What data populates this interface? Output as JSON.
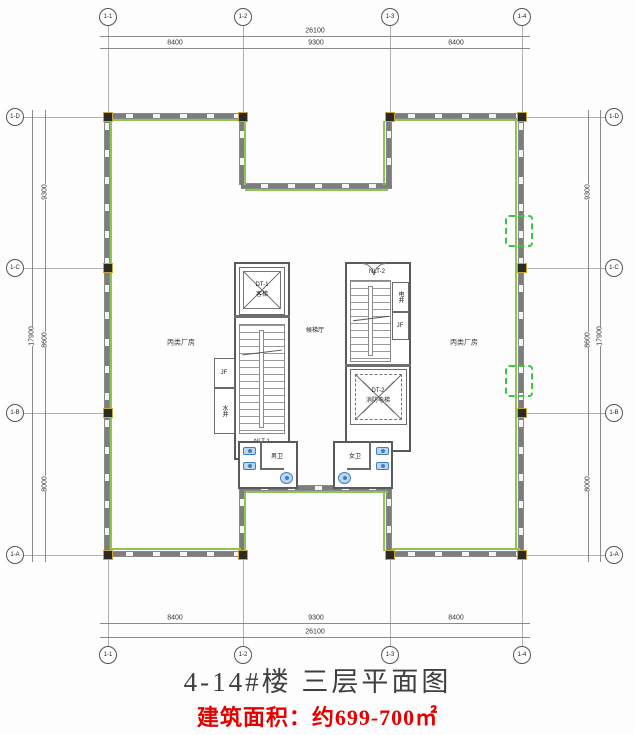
{
  "drawing": {
    "title": "4-14#楼 三层平面图",
    "area_note": "建筑面积：约699-700㎡"
  },
  "axes": {
    "top": {
      "bubbles": [
        "1-1",
        "1-2",
        "1-3",
        "1-4"
      ],
      "total": "26100",
      "segments": [
        "8400",
        "9300",
        "8400"
      ]
    },
    "bottom": {
      "bubbles": [
        "1-1",
        "1-2",
        "1-3",
        "1-4"
      ],
      "total": "26100",
      "segments": [
        "8400",
        "9300",
        "8400"
      ]
    },
    "left": {
      "bubbles": [
        "1-D",
        "1-C",
        "1-B",
        "1-A"
      ],
      "total": "17900",
      "segments": [
        "9300",
        "8600",
        "8000"
      ]
    },
    "right": {
      "bubbles": [
        "1-D",
        "1-C",
        "1-B",
        "1-A"
      ],
      "total": "17900",
      "segments": [
        "9300",
        "8600",
        "8000"
      ]
    }
  },
  "rooms": {
    "left_hall": "丙类厂房",
    "right_hall": "丙类厂房",
    "lobby": "候梯厅",
    "elevator_1_id": "DT-1",
    "elevator_1_type": "客梯",
    "elevator_2_id": "DT-2",
    "elevator_2_type": "消防电梯",
    "stair_1": "NLT-1",
    "stair_2": "NLT-2",
    "shaft_jf_left": "JF",
    "shaft_water": "水井",
    "shaft_elec": "电井",
    "shaft_jf_right": "JF",
    "toilet_left": "男卫",
    "toilet_right": "女卫"
  },
  "colors": {
    "wall_gray": "#7d7d7d",
    "window_green": "#8cc455",
    "column_dark": "#2b2b24",
    "column_accent": "#c9a53a",
    "fixture_blue": "#3e7fc1",
    "dashed_green": "#35c93c",
    "area_red": "#e60000"
  }
}
